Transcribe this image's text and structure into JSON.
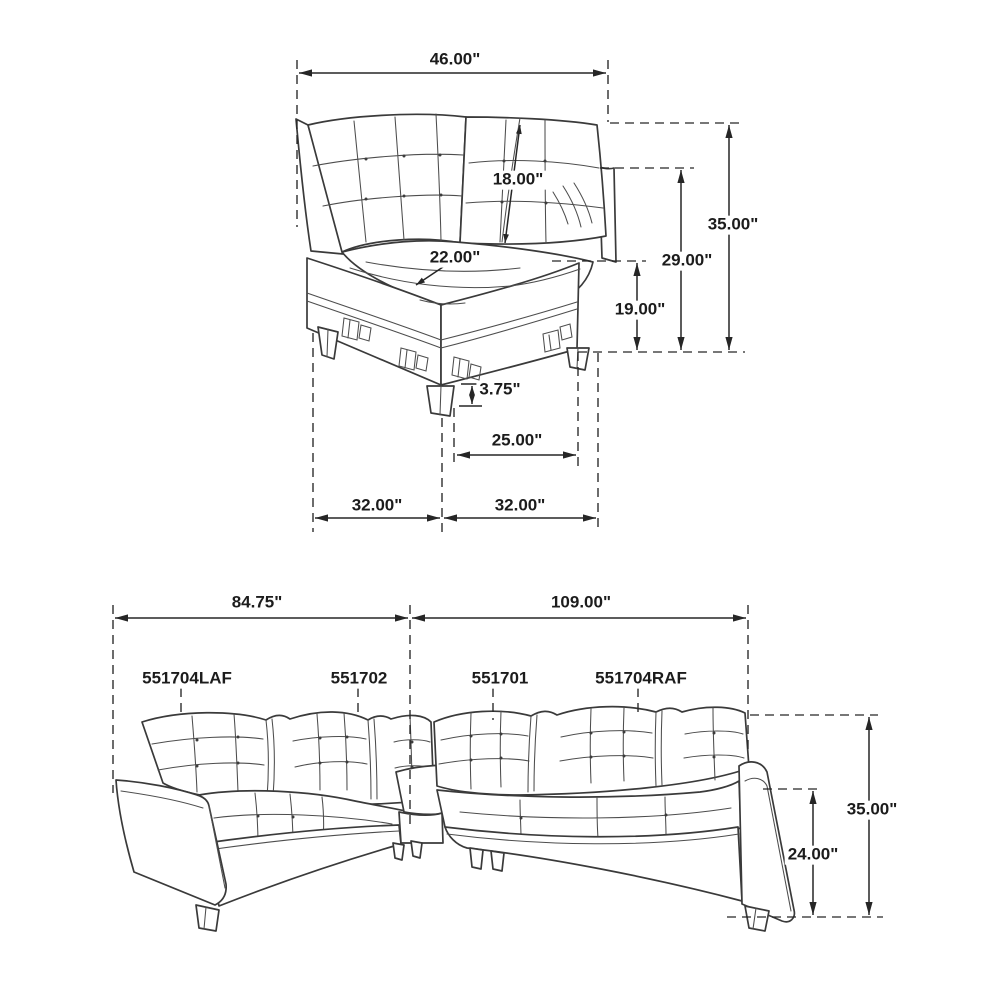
{
  "corner_module_diagram": {
    "width_label": "46.00\"",
    "back_cushion_label": "18.00\"",
    "seat_label": "22.00\"",
    "total_height_label": "35.00\"",
    "back_height_label": "29.00\"",
    "base_height_label": "19.00\"",
    "leg_height_label": "3.75\"",
    "front_span_label": "25.00\"",
    "left_depth_label": "32.00\"",
    "right_depth_label": "32.00\""
  },
  "sectional_diagram": {
    "left_length_label": "84.75\"",
    "right_length_label": "109.00\"",
    "height_label": "35.00\"",
    "arm_height_label": "24.00\"",
    "parts": [
      {
        "sku": "551704LAF"
      },
      {
        "sku": "551702"
      },
      {
        "sku": "551701"
      },
      {
        "sku": "551704RAF"
      }
    ]
  }
}
